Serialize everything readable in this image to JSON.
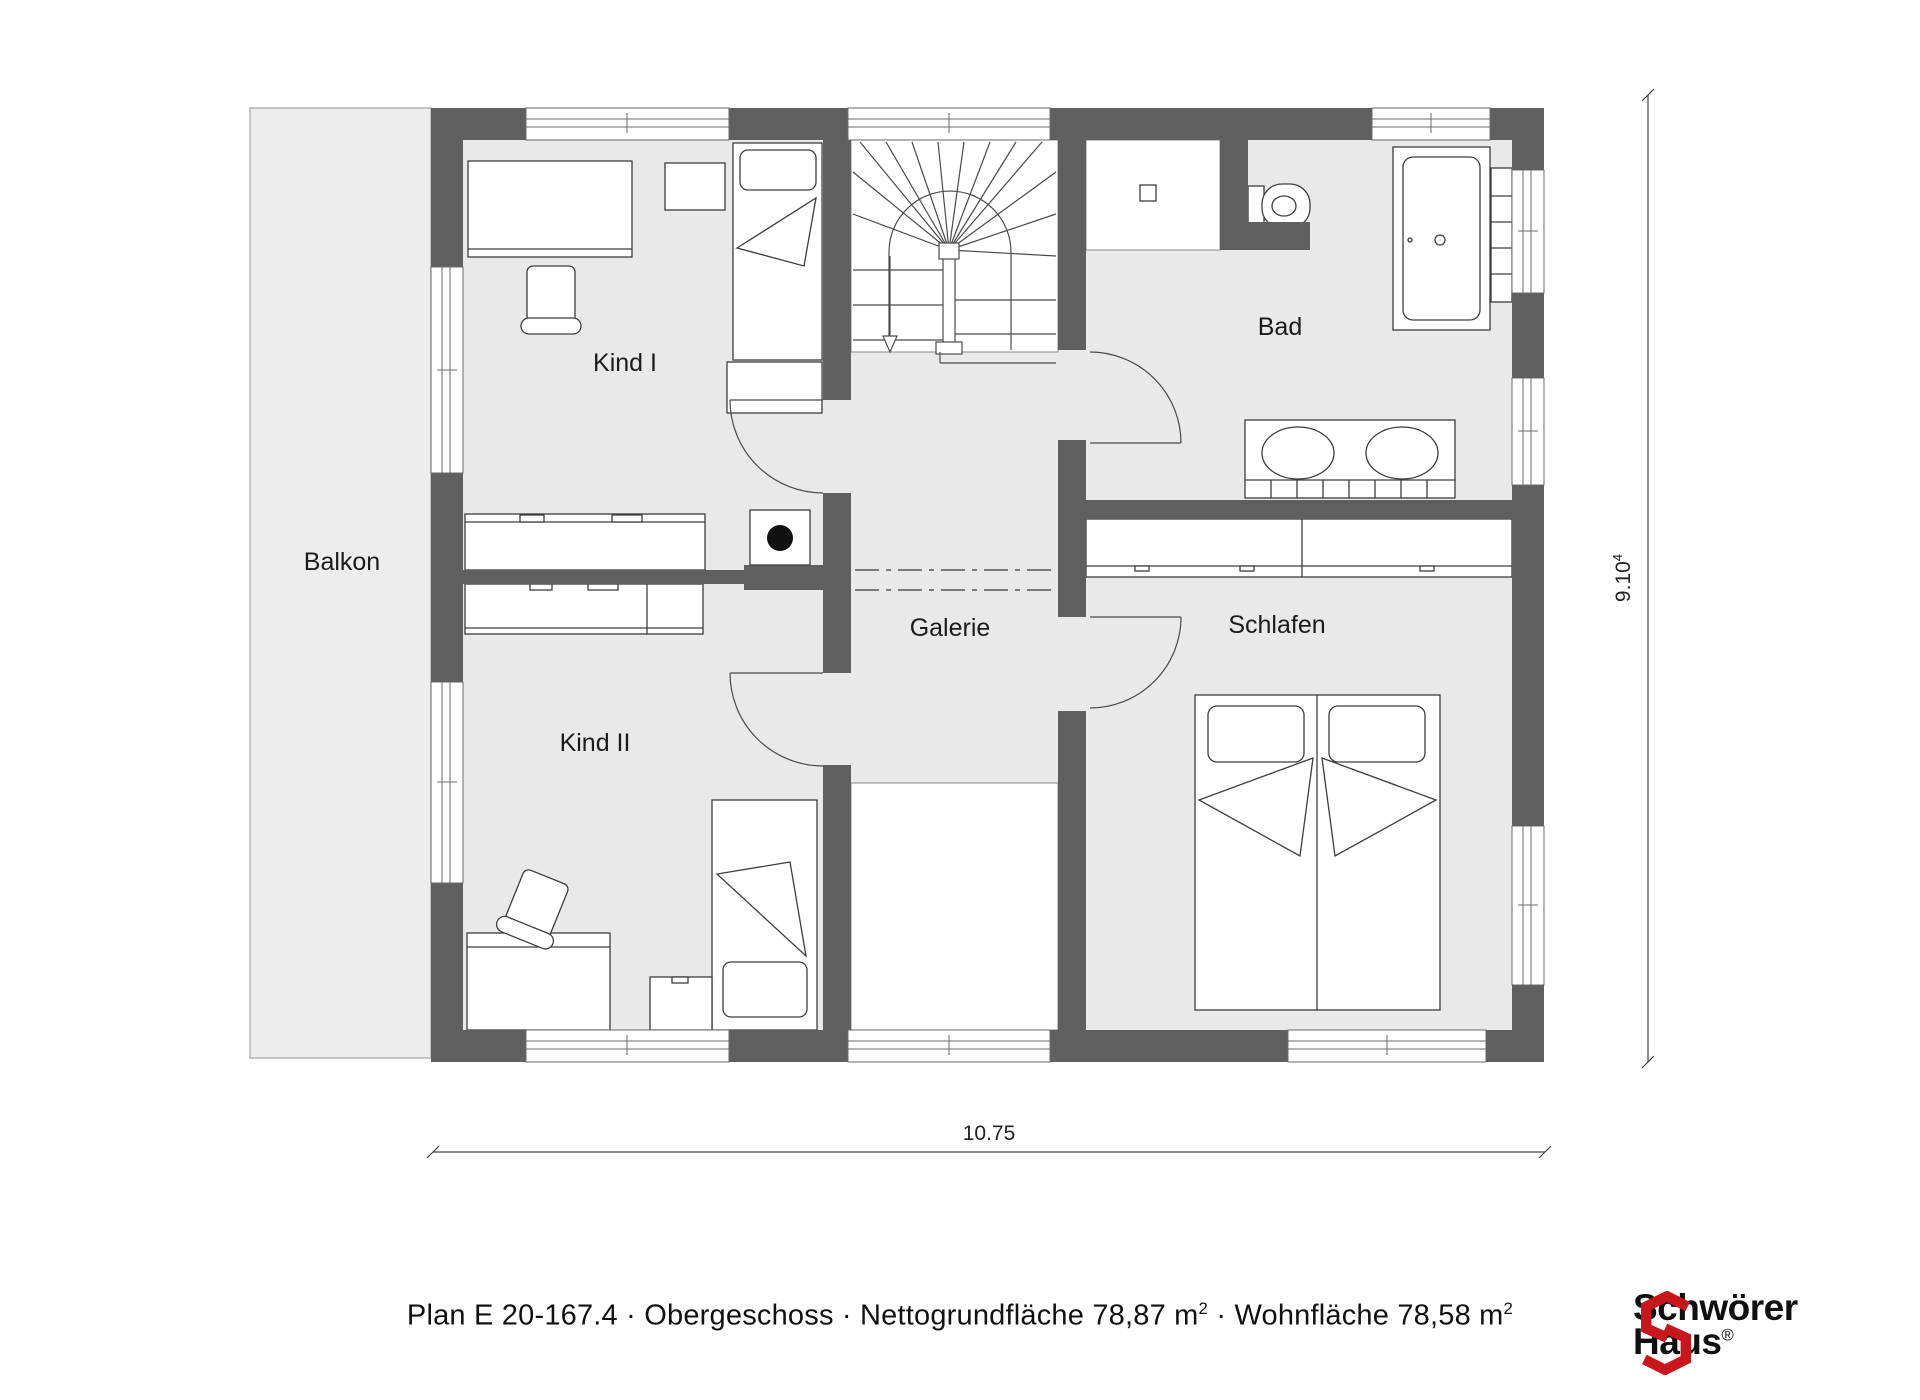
{
  "plan": {
    "rooms": [
      {
        "name": "balkon",
        "label": "Balkon"
      },
      {
        "name": "kind-1",
        "label": "Kind I"
      },
      {
        "name": "kind-2",
        "label": "Kind II"
      },
      {
        "name": "galerie",
        "label": "Galerie"
      },
      {
        "name": "bad",
        "label": "Bad"
      },
      {
        "name": "schlafen",
        "label": "Schlafen"
      }
    ],
    "dimensions": {
      "width_value": "10.75",
      "height_value": "9.10",
      "height_sup": "4"
    },
    "stairs": {
      "direction_arrow": "down"
    },
    "colors": {
      "wall": "#5f5f5f",
      "room_fill": "#e9e9e9",
      "balcony_fill": "#ededed",
      "line": "#3d3d3d",
      "logo_red": "#c8161d"
    }
  },
  "caption": {
    "parts": [
      {
        "text": "Plan E 20-167.4 · Obergeschoss · Nettogrundfläche 78,87 m"
      },
      {
        "text": "2",
        "sup": true
      },
      {
        "text": " · Wohnfläche 78,58 m"
      },
      {
        "text": "2",
        "sup": true
      }
    ]
  },
  "logo": {
    "brand_line1": "Schwörer",
    "brand_line2": "Haus",
    "registered": "®"
  }
}
